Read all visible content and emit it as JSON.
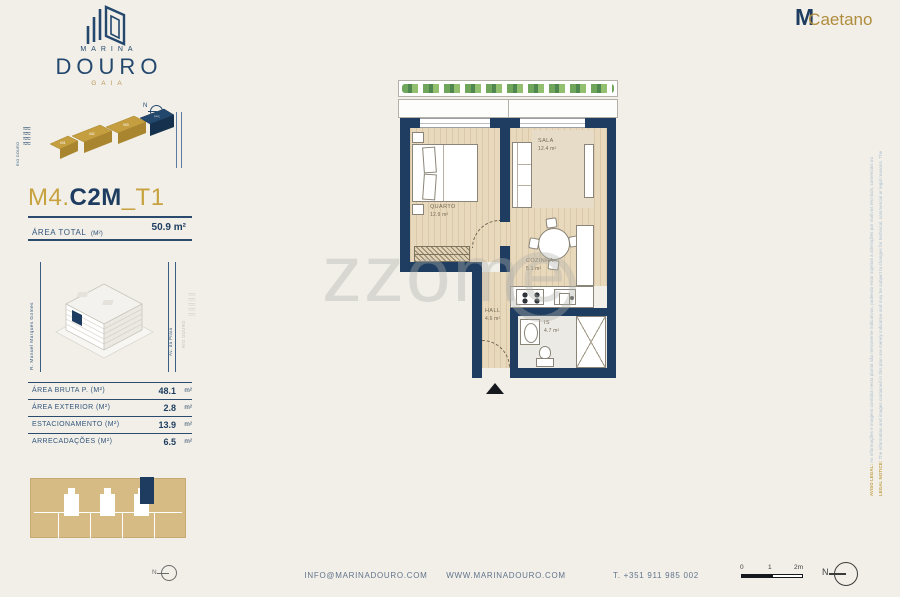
{
  "brand": {
    "marina": "MARINA",
    "douro": "DOURO",
    "gaia": "GAIA"
  },
  "agency": {
    "m": "M",
    "caetano": "Caetano"
  },
  "site_map": {
    "river": "RIO DOURO",
    "blocks": [
      "M1",
      "M2",
      "M3",
      "M4"
    ]
  },
  "unit_header": {
    "block": "M4.",
    "model": "C2M",
    "typology": "_T1",
    "area_label": "ÁREA TOTAL",
    "area_unit": "(M²)",
    "area_value": "50.9 m²"
  },
  "context": {
    "street_left": "R. Manuel Marques Gomes",
    "street_right": "Av. da Praia",
    "river": "RIO DOURO"
  },
  "area_table": {
    "rows": [
      {
        "label": "ÁREA BRUTA P.  (M²)",
        "value": "48.1",
        "suffix": "m²"
      },
      {
        "label": "ÁREA EXTERIOR (M²)",
        "value": "2.8",
        "suffix": "m²"
      },
      {
        "label": "ESTACIONAMENTO (M²)",
        "value": "13.9",
        "suffix": "m²"
      },
      {
        "label": "ARRECADAÇÕES (M²)",
        "value": "6.5",
        "suffix": "m²"
      }
    ]
  },
  "floorplan": {
    "rooms": {
      "quarto": {
        "name": "QUARTO",
        "area": "12.9 m²"
      },
      "sala": {
        "name": "SALA",
        "area": "12.4 m²"
      },
      "cozinha": {
        "name": "COZINHA",
        "area": "5.1 m²"
      },
      "hall": {
        "name": "HALL",
        "area": "4.6 m²"
      },
      "is": {
        "name": "IS",
        "area": "4.7 m²"
      }
    }
  },
  "watermark": {
    "text": "zzome"
  },
  "footer": {
    "email": "INFO@MARINADOURO.COM",
    "website": "WWW.MARINADOURO.COM",
    "phone": "T. +351 911 985 002"
  },
  "scale_bar": {
    "zero": "0",
    "one": "1",
    "two": "2m"
  },
  "compass": {
    "label": "N"
  },
  "legal": {
    "pt_lead": "AVISO LEGAL:",
    "pt_text": " As informações e imagens contidas nesta planta são meramente indicativas, podendo estar sujeitas a alterações por motivos técnicos, comerciais ou legais. As áreas indicadas são aproximadas e o mobiliário representado constitui apenas uma sugestão de decoração.",
    "en_lead": "LEGAL NOTICE:",
    "en_text": " The information and images contained in this plan are merely indicative and may be subject to changes for technical, commercial or legal reasons. The areas shown are approximate and all furniture and equipment are shown as a decoration suggestion only."
  },
  "colors": {
    "navy": "#1d3c5f",
    "gold": "#c7a23f",
    "background": "#f1efe8"
  }
}
